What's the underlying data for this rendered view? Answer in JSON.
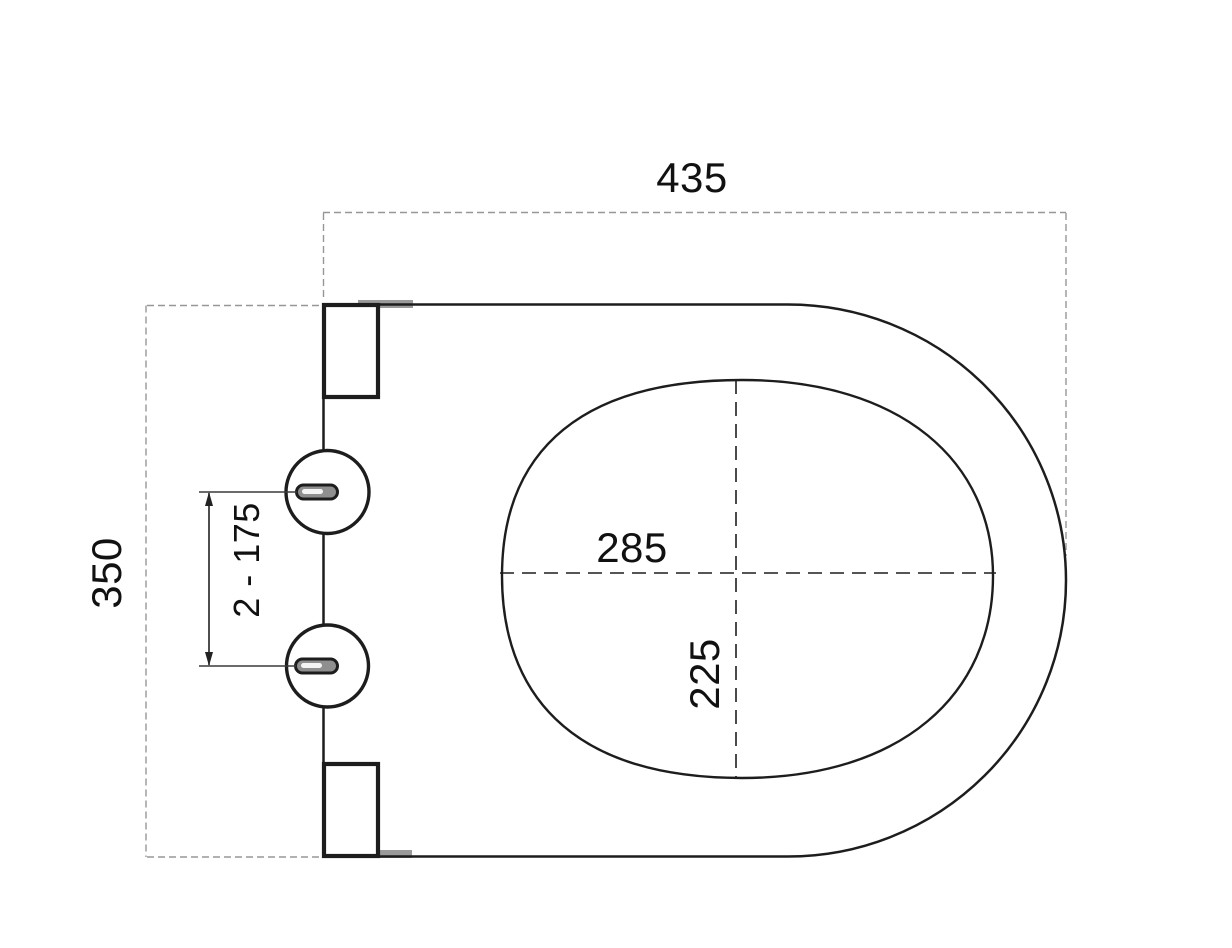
{
  "drawing": {
    "dimensions": {
      "overall_width": "435",
      "overall_depth": "350",
      "inner_length": "285",
      "inner_width": "225",
      "hinge_hole_spacing": "2 - 175"
    },
    "colors": {
      "line": "#1d1d1d",
      "guide_dash": "#979797",
      "hinge_slot_fill": "#8f8f8f",
      "background": "#ffffff"
    }
  }
}
